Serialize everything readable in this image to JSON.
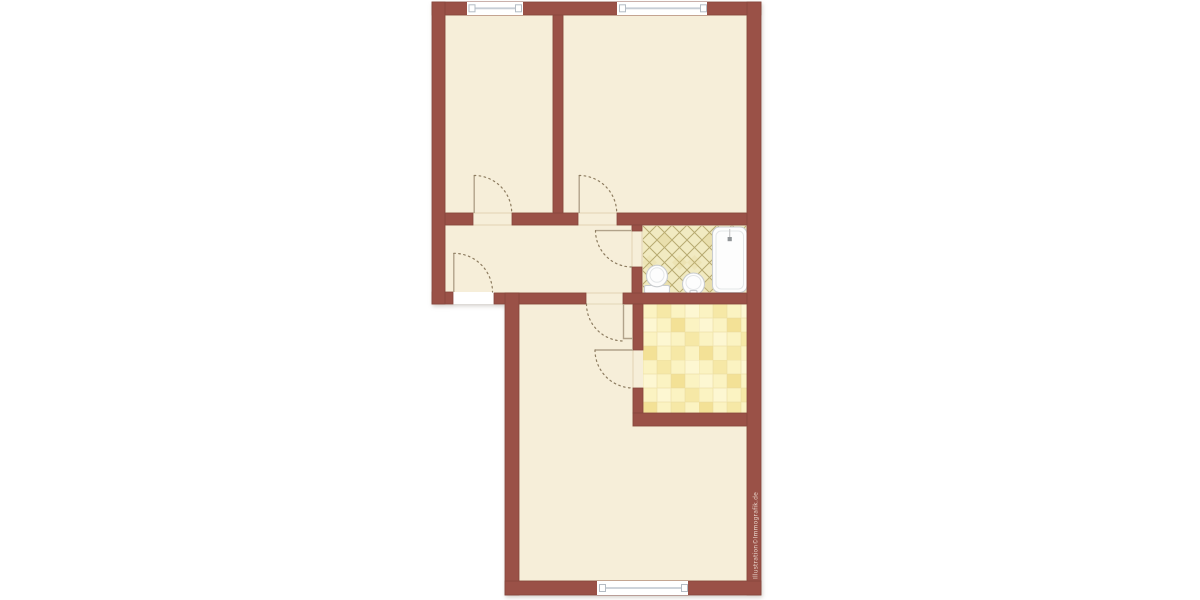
{
  "page": {
    "type": "architectural-floor-plan",
    "background": "#ffffff"
  },
  "watermark": "Illustration©Immografik.de",
  "colors": {
    "outside": "#ffffff",
    "wall": "#9a5147",
    "wall-line": "#86473d",
    "floor": "#f6eed9",
    "floor-shade": "#e9ddc2",
    "threshold": "#ffffff",
    "bath-tile": "#f1eac1",
    "bath-line": "#b7aa70",
    "bath-shade": "#d9c97f",
    "kit-a": "#fbf3c2",
    "kit-b": "#f6e8a6",
    "kit-c": "#fdf7d2",
    "kit-d": "#f3e196",
    "kit-grid": "#e7d99c",
    "window-line": "#c7ced6",
    "window-cap-line": "#b4bcc4",
    "fixture-line": "#c9cccf",
    "fixture-inner": "#e4e6e8",
    "door-arc": "#8d7c60",
    "door-leaf": "#b1a28a"
  },
  "floorplan": {
    "rooms": [
      {
        "name": "room-top-left",
        "floor": "plain"
      },
      {
        "name": "room-top-right",
        "floor": "plain"
      },
      {
        "name": "hallway",
        "floor": "plain"
      },
      {
        "name": "bathroom",
        "floor": "diagonal-tiles"
      },
      {
        "name": "kitchen",
        "floor": "checkered-tiles"
      },
      {
        "name": "living-room",
        "floor": "plain"
      }
    ],
    "fixtures": [
      "bathtub",
      "toilet",
      "sink"
    ],
    "window_count": 3,
    "door_count": 6
  }
}
